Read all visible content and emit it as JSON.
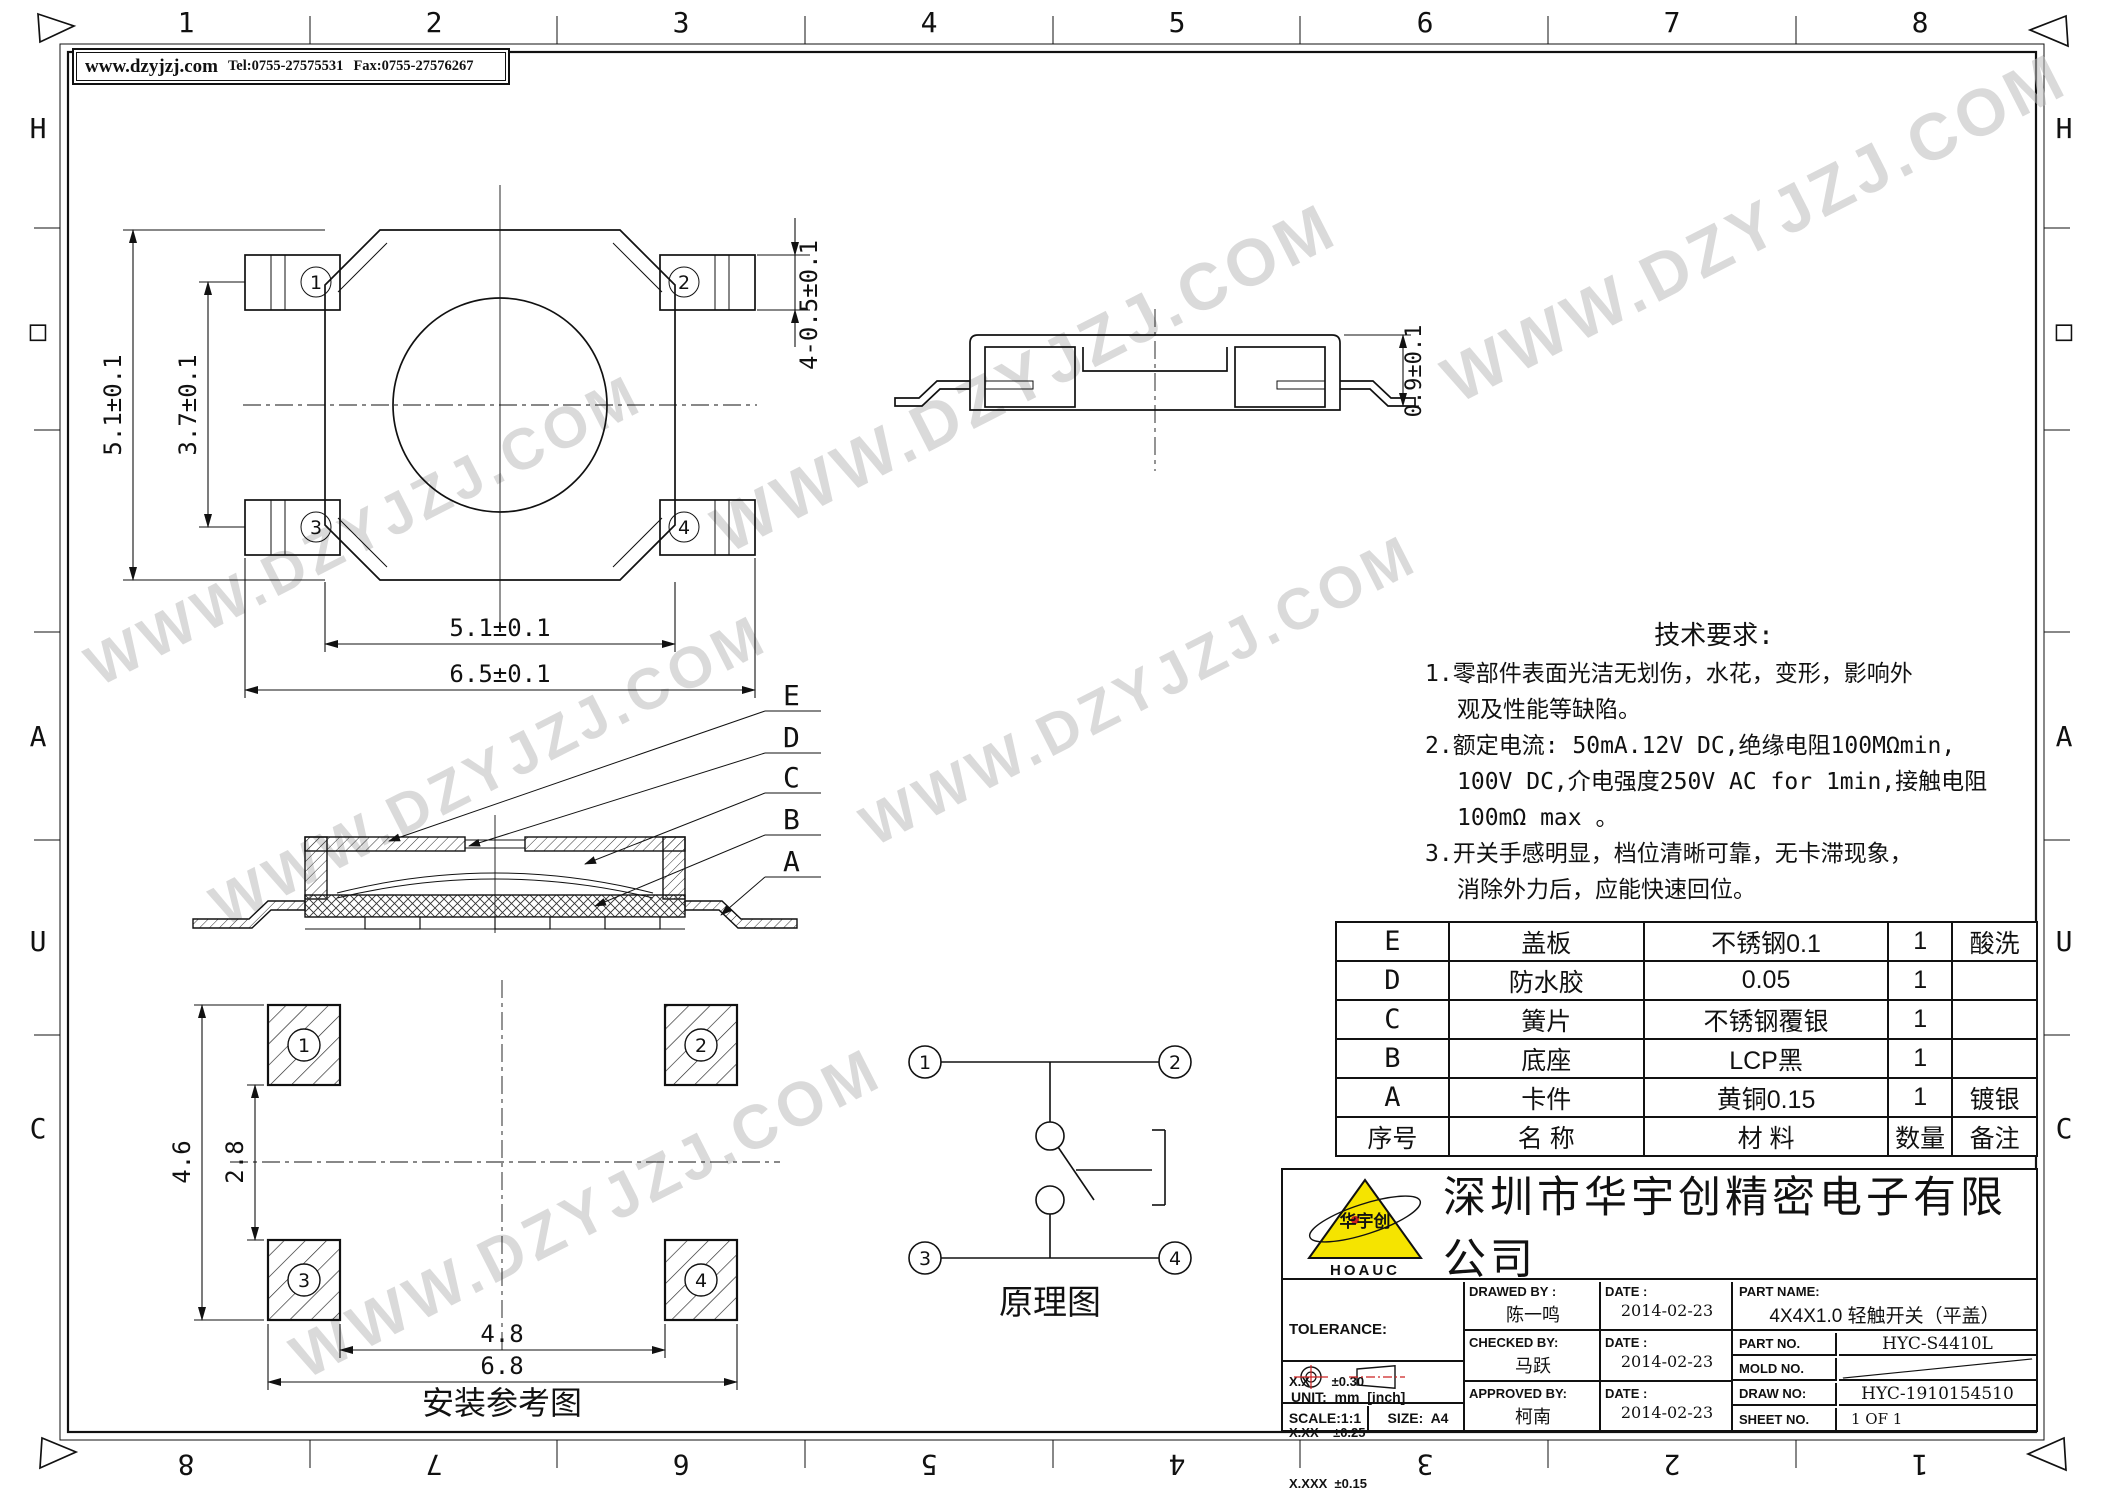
{
  "watermark": "WWW.DZYJZJ.COM",
  "header": {
    "url": "www.dzyjzj.com",
    "tel": "Tel:0755-27575531",
    "fax": "Fax:0755-27576267"
  },
  "border": {
    "top_numbers": [
      "1",
      "2",
      "3",
      "4",
      "5",
      "6",
      "7",
      "8"
    ],
    "bottom_numbers": [
      "8",
      "7",
      "6",
      "5",
      "4",
      "3",
      "2",
      "1"
    ],
    "left_letters": [
      "H",
      "□",
      "A",
      "U",
      "C"
    ],
    "right_letters": [
      "H",
      "□",
      "A",
      "U",
      "C"
    ]
  },
  "top_view": {
    "pins": [
      "1",
      "2",
      "3",
      "4"
    ],
    "dim_height": "5.1±0.1",
    "dim_pin_span": "3.7±0.1",
    "dim_pin_width": "4-0.5±0.1",
    "dim_body_width": "5.1±0.1",
    "dim_overall_width": "6.5±0.1"
  },
  "side_view": {
    "dim_height": "0.9±0.1"
  },
  "section_view": {
    "labels": [
      "E",
      "D",
      "C",
      "B",
      "A"
    ]
  },
  "mount_view": {
    "pads": [
      "1",
      "2",
      "3",
      "4"
    ],
    "dim_outer_v": "4.6",
    "dim_inner_v": "2.8",
    "dim_inner_h": "4.8",
    "dim_outer_h": "6.8",
    "caption": "安装参考图"
  },
  "schematic": {
    "terminals": [
      "1",
      "2",
      "3",
      "4"
    ],
    "caption": "原理图"
  },
  "tech_req": {
    "title": "技术要求:",
    "lines": [
      "1.零部件表面光洁无划伤，水花，变形，影响外",
      "观及性能等缺陷。",
      "2.额定电流: 50mA.12V DC,绝缘电阻100MΩmin,",
      "100V DC,介电强度250V AC for 1min,接触电阻",
      "100mΩ max 。",
      "3.开关手感明显，档位清晰可靠，无卡滞现象，",
      "消除外力后，应能快速回位。"
    ]
  },
  "parts_table": {
    "header": [
      "序号",
      "名  称",
      "材  料",
      "数量",
      "备注"
    ],
    "rows": [
      [
        "E",
        "盖板",
        "不锈钢0.1",
        "1",
        "酸洗"
      ],
      [
        "D",
        "防水胶",
        "0.05",
        "1",
        ""
      ],
      [
        "C",
        "簧片",
        "不锈钢覆银",
        "1",
        ""
      ],
      [
        "B",
        "底座",
        "LCP黑",
        "1",
        ""
      ],
      [
        "A",
        "卡件",
        "黄铜0.15",
        "1",
        "镀银"
      ]
    ]
  },
  "title_block": {
    "company": "深圳市华宇创精密电子有限公司",
    "logo_cn": "华宇创",
    "logo_en": "HOAUC",
    "logo_color": "#f5e400",
    "accent_red": "#cc2222",
    "tolerance_title": "TOLERANCE:",
    "tol_rows": [
      "X.X      ±0.30",
      "X.XX    ±0.25",
      "X.XXX  ±0.15"
    ],
    "tol_angles": "X.° ±2°    X.X° ±0.5°",
    "unit": "UNIT:  mm  [inch]",
    "scale": "SCALE:1:1",
    "size": "SIZE:  A4",
    "sign_rows": [
      {
        "label": "DRAWED BY :",
        "name": "陈一鸣",
        "date_label": "DATE :",
        "date": "2014-02-23"
      },
      {
        "label": "CHECKED BY:",
        "name": "马跃",
        "date_label": "DATE :",
        "date": "2014-02-23"
      },
      {
        "label": "APPROVED BY:",
        "name": "柯南",
        "date_label": "DATE :",
        "date": "2014-02-23"
      }
    ],
    "part_name_label": "PART NAME:",
    "part_name": "4X4X1.0 轻触开关（平盖）",
    "right_rows": [
      {
        "label": "PART NO.",
        "value": "HYC-S4410L"
      },
      {
        "label": "MOLD NO.",
        "value": ""
      },
      {
        "label": "DRAW NO:",
        "value": "HYC-1910154510"
      },
      {
        "label": "SHEET NO.",
        "value": "1 OF 1"
      }
    ]
  }
}
